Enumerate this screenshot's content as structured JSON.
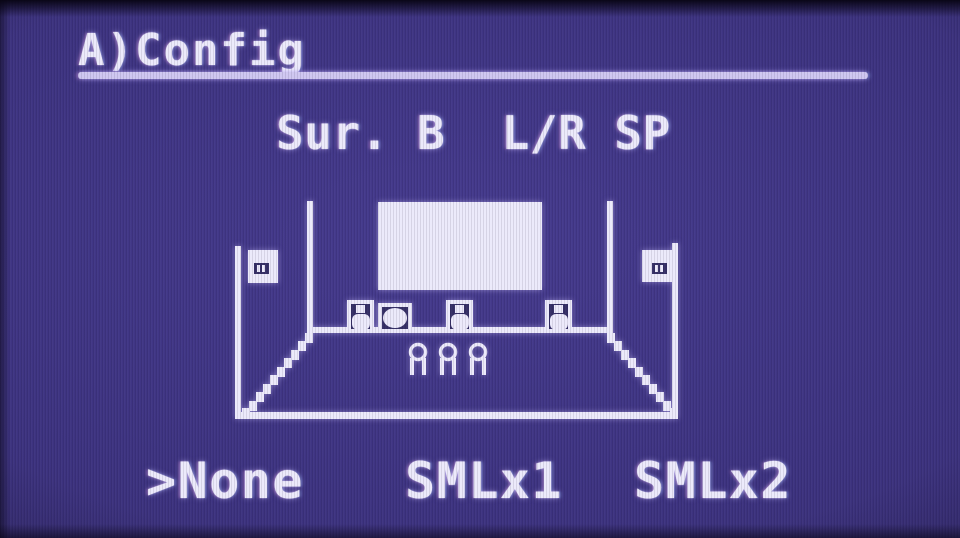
{
  "window": {
    "width": 960,
    "height": 538,
    "kind": "av-receiver-osd-menu"
  },
  "colors": {
    "background": "#3d3380",
    "foreground": "#eceafb",
    "underline": "#cfc7f1",
    "edge_shadow": "#07041 2"
  },
  "header": {
    "title": "A)Config"
  },
  "page": {
    "subtitle": "Sur. B  L/R SP"
  },
  "diagram": {
    "name": "room-speaker-layout",
    "icons": [
      "tv-screen",
      "front-left-speaker-icon",
      "subwoofer-icon",
      "center-speaker-icon",
      "front-right-speaker-icon",
      "surround-left-speaker-icon",
      "surround-right-speaker-icon",
      "listener-icon",
      "room-outline"
    ],
    "listener_count": 3
  },
  "options": {
    "cursor": ">",
    "selected": "None",
    "items": [
      {
        "label": "None",
        "display": ">None",
        "selected": true
      },
      {
        "label": "SMLx1",
        "display": "SMLx1",
        "selected": false
      },
      {
        "label": "SMLx2",
        "display": "SMLx2",
        "selected": false
      }
    ]
  }
}
